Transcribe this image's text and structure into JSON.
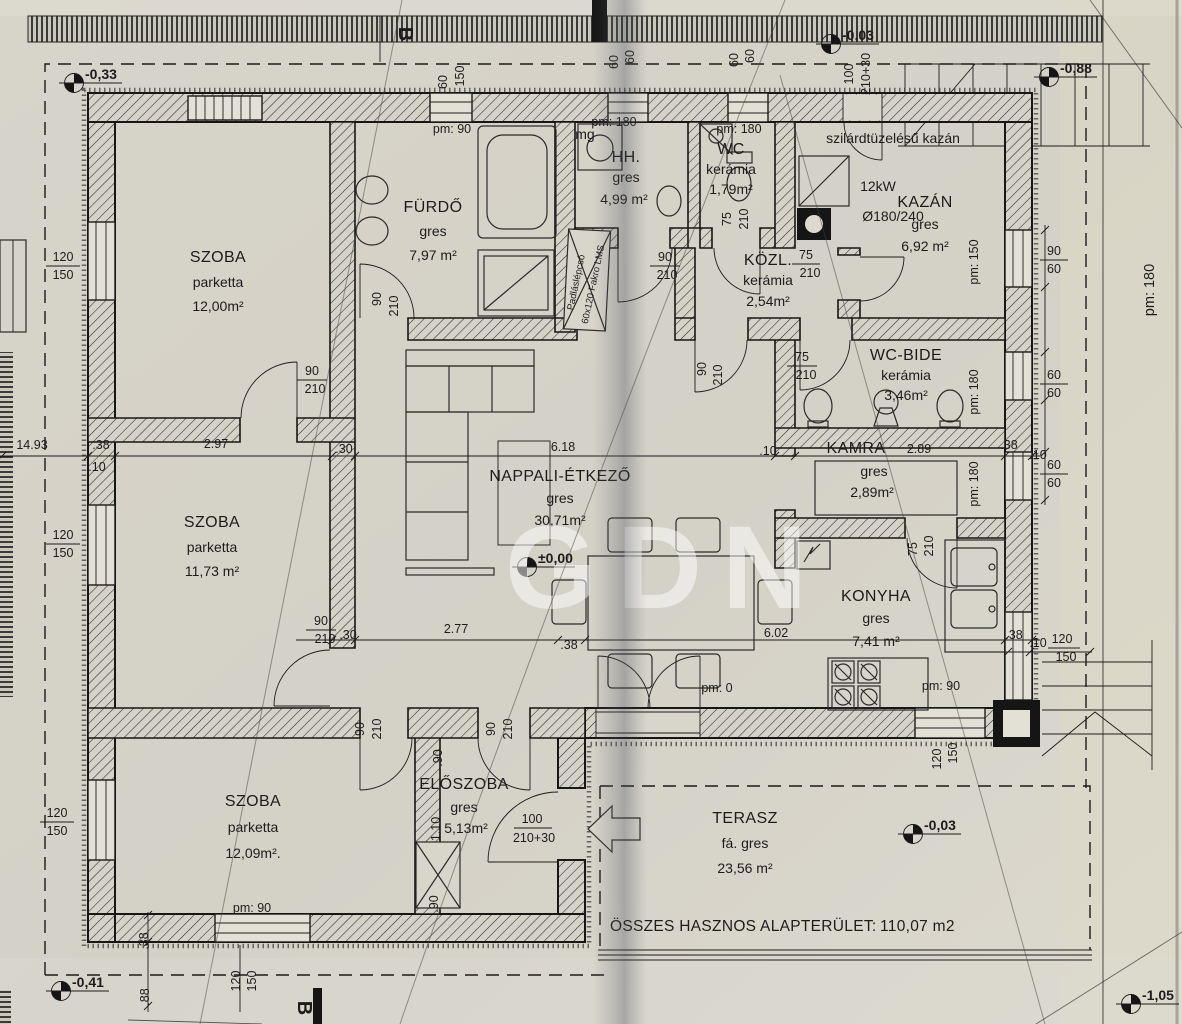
{
  "drawing": {
    "watermark": "GDN",
    "section_letter": "B",
    "total_area_label": "ÖSSZES HASZNOS ALAPTERÜLET:",
    "total_area_value": "110,07 m2"
  },
  "rooms": [
    {
      "id": "szoba-1",
      "name": "SZOBA",
      "finish": "parketta",
      "area": "12,00m²"
    },
    {
      "id": "furdo",
      "name": "FÜRDŐ",
      "finish": "gres",
      "area": "7,97 m²"
    },
    {
      "id": "hh",
      "name": "HH.",
      "finish": "gres",
      "area": "4,99 m²"
    },
    {
      "id": "wc",
      "name": "WC",
      "finish": "kerámia",
      "area": "1,79m²"
    },
    {
      "id": "kazan",
      "name": "KAZÁN",
      "finish": "gres",
      "area": "6,92 m²"
    },
    {
      "id": "kozl",
      "name": "KÖZL.",
      "finish": "kerámia",
      "area": "2,54m²"
    },
    {
      "id": "wc-bide",
      "name": "WC-BIDE",
      "finish": "kerámia",
      "area": "3,46m²"
    },
    {
      "id": "kamra",
      "name": "KAMRA",
      "width": "2.89",
      "finish": "gres",
      "area": "2,89m²"
    },
    {
      "id": "nappali-etkezo",
      "name": "NAPPALI-ÉTKEZŐ",
      "finish": "gres",
      "area": "30,71m²"
    },
    {
      "id": "szoba-2",
      "name": "SZOBA",
      "finish": "parketta",
      "area": "11,73 m²"
    },
    {
      "id": "szoba-3",
      "name": "SZOBA",
      "finish": "parketta",
      "area": "12,09m²."
    },
    {
      "id": "eloszoba",
      "name": "ELŐSZOBA",
      "finish": "gres",
      "area": "5,13m²"
    },
    {
      "id": "konyha",
      "name": "KONYHA",
      "finish": "gres",
      "area": "7,41 m²"
    },
    {
      "id": "terasz",
      "name": "TERASZ",
      "finish": "fá. gres",
      "area": "23,56 m²"
    }
  ],
  "annotations": {
    "washing_machine": "mg",
    "boiler_room_note": "szilárdtüzelésű kazán",
    "boiler_power": "12kW",
    "chimney_size": "Ø180/240",
    "attic_ladder_1": "Padláslépcső",
    "attic_ladder_2": "60x120 Fakro LMS"
  },
  "levels": [
    "-0,33",
    "-0,03",
    "-0,88",
    "±0,00",
    "-0,03",
    "-0,41",
    "-1,05"
  ],
  "pm_labels": [
    "pm: 90",
    "pm: 180",
    "pm: 180",
    "pm: 150",
    "pm: 180",
    "pm: 180",
    "pm: 180",
    "pm: 0",
    "pm: 90",
    "pm: 90"
  ],
  "dims": [
    "14.93",
    ".38",
    "2.97",
    ".30",
    "6.18",
    ".10",
    ".38",
    ".10",
    ".10",
    "120",
    "150",
    "120",
    "150",
    "120",
    "150",
    "60",
    "150",
    "60",
    "60",
    "60",
    "60",
    "100",
    "210+30",
    "90",
    "60",
    "60",
    "60",
    "60",
    "60",
    ".38",
    ".10",
    "120",
    "150",
    "120",
    "150",
    "90",
    "210",
    ".30",
    "2.77",
    ".38",
    "6.02",
    "90",
    "210",
    "90",
    "210",
    "90",
    "210",
    "75",
    "210",
    "75",
    "210",
    "90",
    "210",
    "75",
    "210",
    "75",
    "210",
    "90",
    "210",
    "90",
    "210",
    "100",
    "210+30",
    ".90",
    "1.10",
    ".90",
    ".38",
    ".88",
    "120",
    "150"
  ]
}
